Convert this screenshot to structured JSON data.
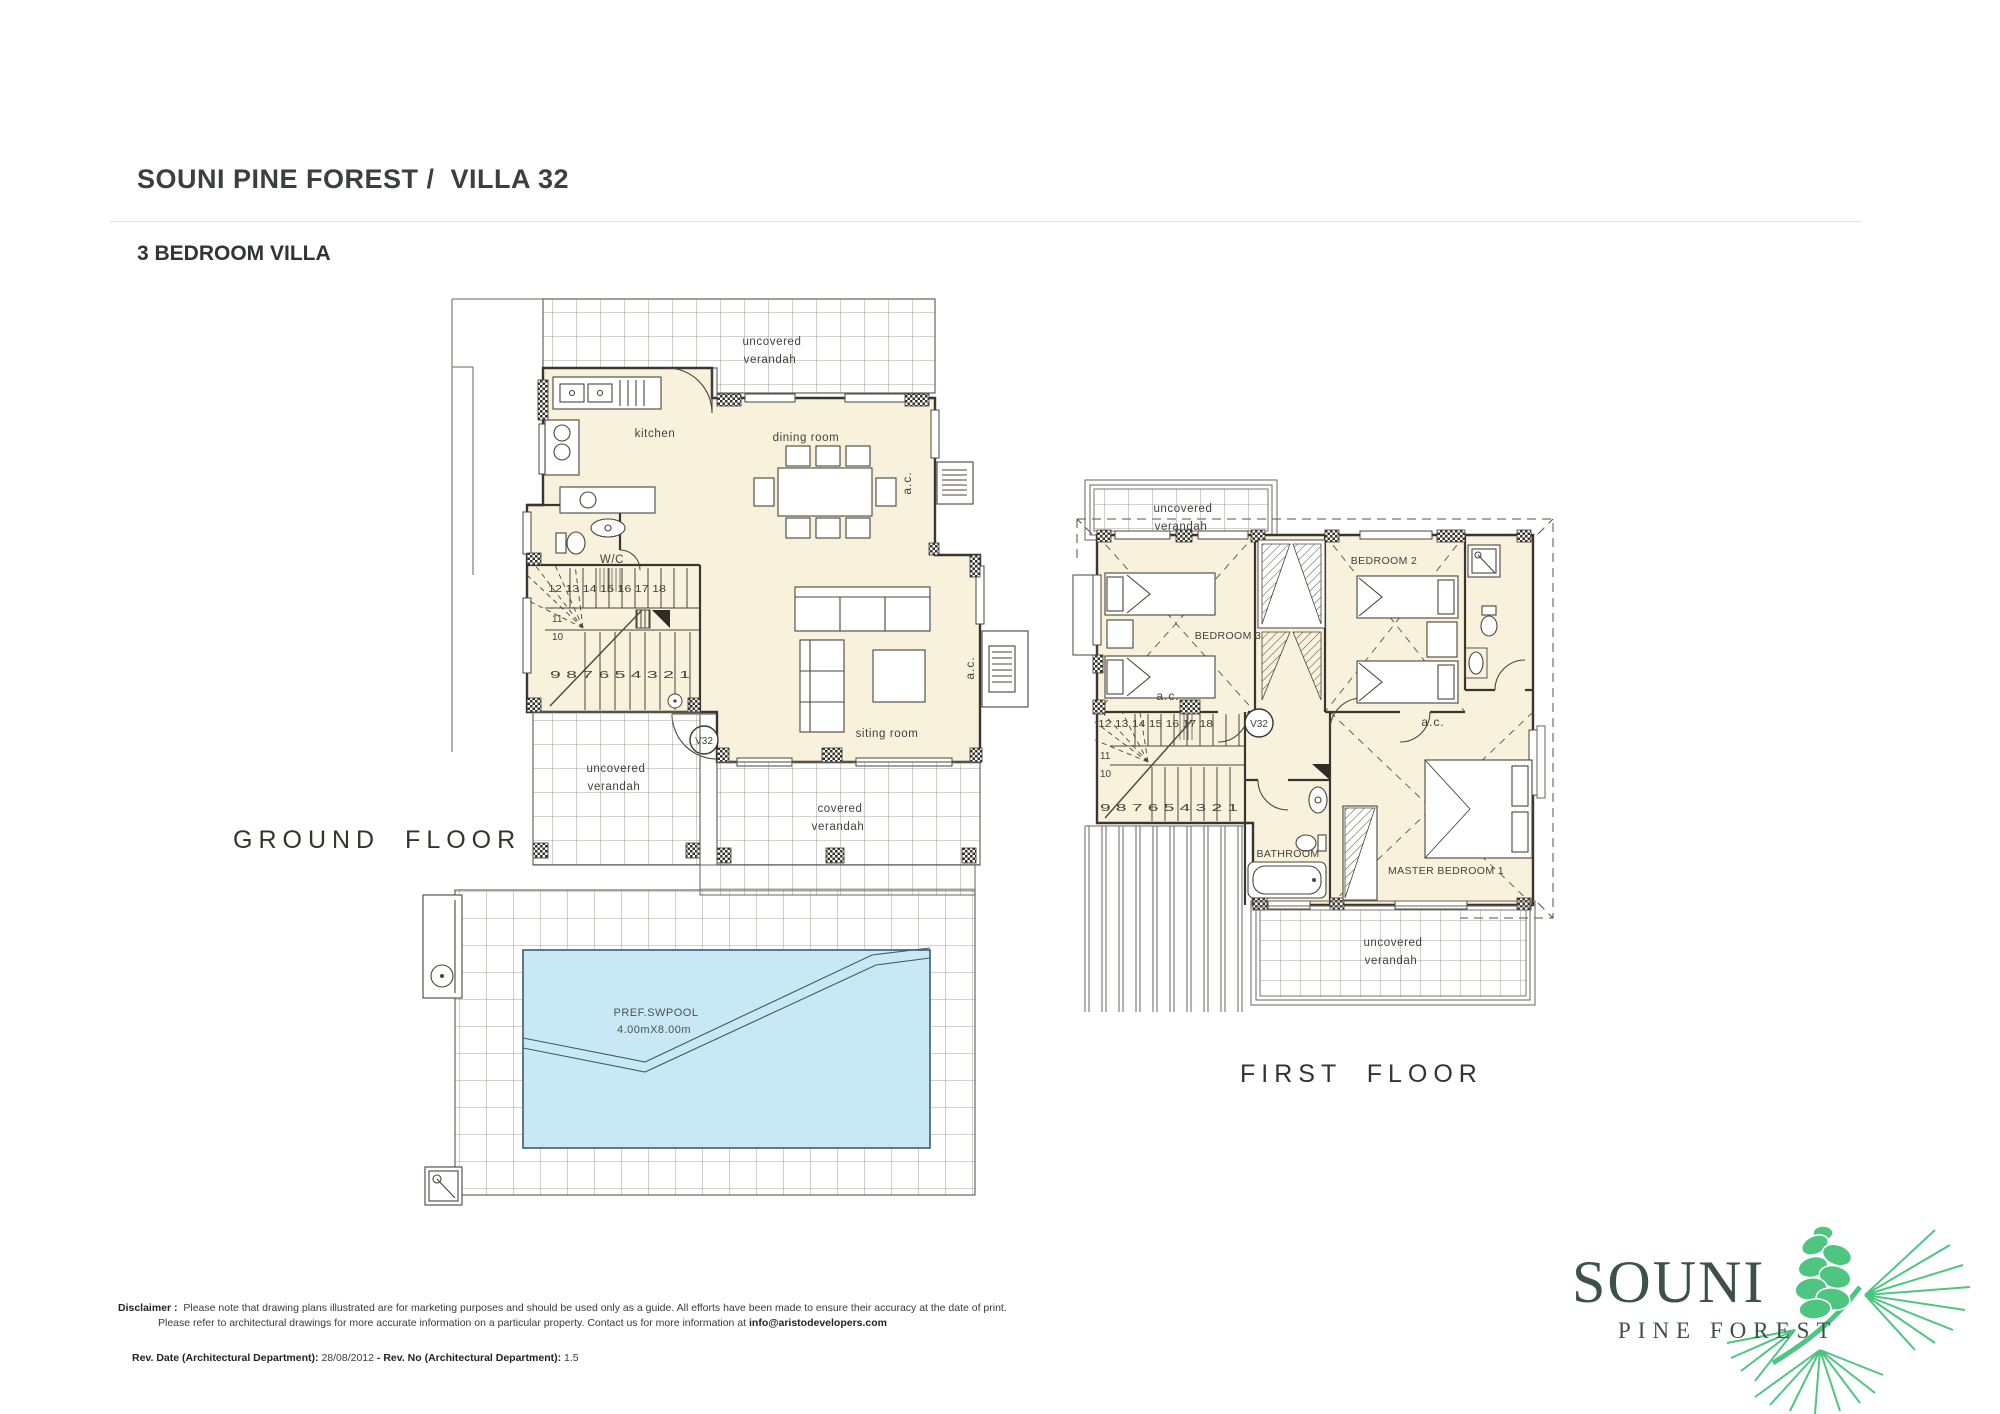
{
  "header": {
    "title": "SOUNI PINE FOREST /  VILLA 32",
    "subtitle": "3 BEDROOM VILLA"
  },
  "plan_common": {
    "villa_tag": "V32",
    "ac_unit": "a.c.",
    "wc": "W/C",
    "verandah": {
      "uncovered_line1": "uncovered",
      "uncovered_line2": "verandah",
      "covered_line1": "covered",
      "covered_line2": "verandah"
    },
    "stairs": {
      "upper_row": "12 13 14 15 16 17 18",
      "step11": "11",
      "step10": "10",
      "lower_row": "9 8 7 6 5 4 3 2 1"
    }
  },
  "ground_floor": {
    "label": "GROUND FLOOR",
    "kitchen": "kitchen",
    "dining_room": "dining room",
    "sitting_room": "siting room",
    "pool": {
      "title": "PREF.SWPOOL",
      "dimensions": "4.00mX8.00m"
    }
  },
  "first_floor": {
    "label": "FIRST FLOOR",
    "bedroom2": "BEDROOM 2",
    "bedroom3": "BEDROOM 3",
    "master_bedroom": "MASTER BEDROOM 1",
    "bathroom": "BATHROOM"
  },
  "footer": {
    "disclaimer_label": "Disclaimer :",
    "disclaimer_line1": "Please note that drawing plans illustrated are for marketing purposes and should be used only as a guide. All efforts have been made to ensure their accuracy at the date of print.",
    "disclaimer_line2": "Please refer to architectural drawings for more accurate information on a particular property. Contact us for more information at ",
    "disclaimer_email": "info@aristodevelopers.com",
    "rev_date_label": "Rev. Date (Architectural Department):",
    "rev_date_value": "28/08/2012",
    "rev_separator": "-",
    "rev_no_label": "Rev. No (Architectural Department):",
    "rev_no_value": "1.5"
  },
  "logo": {
    "brand": "SOUNI",
    "tagline": "PINE FOREST"
  },
  "colors": {
    "interior_fill": "#f8f1dc",
    "pool_water": "#c9e8f6",
    "logo_green": "#4ec581",
    "logo_text": "#3d5149",
    "plan_line": "#46413a"
  }
}
